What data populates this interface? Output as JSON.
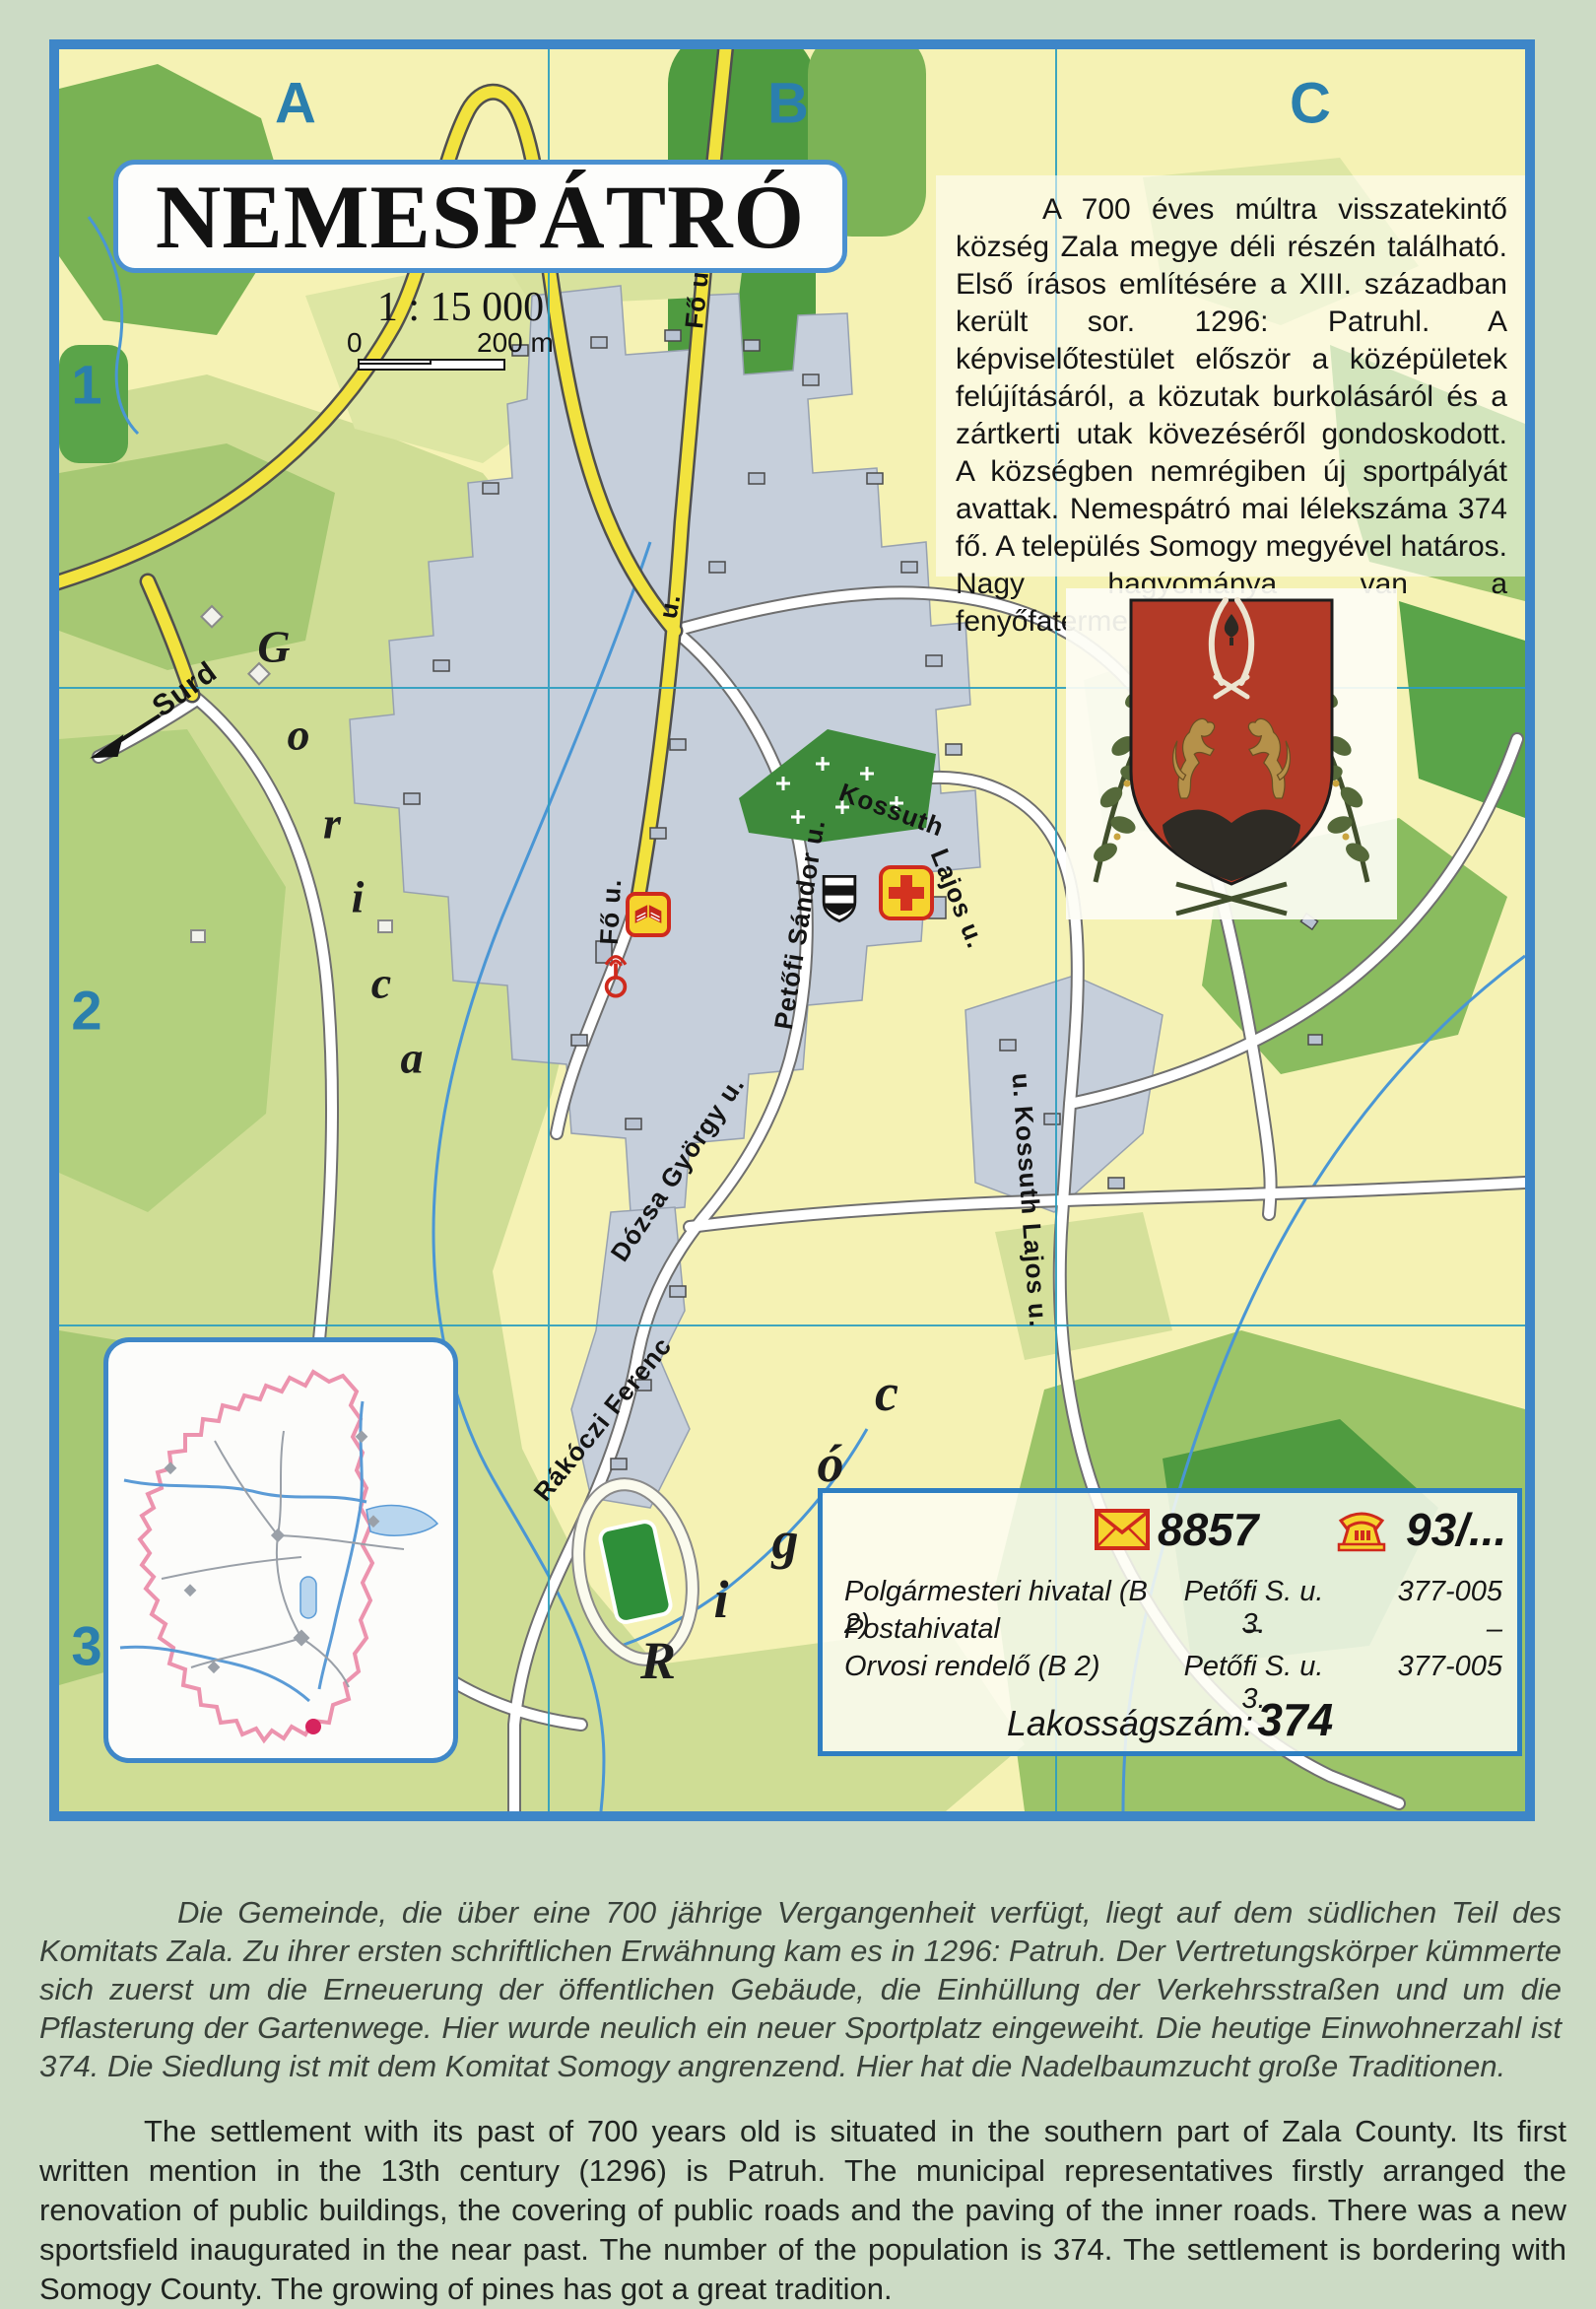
{
  "title": "NEMESPÁTRÓ",
  "scale": {
    "ratio": "1 : 15 000",
    "zero": "0",
    "end": "200 m"
  },
  "grid": {
    "columns": [
      "A",
      "B",
      "C"
    ],
    "rows": [
      "1",
      "2",
      "3"
    ]
  },
  "description_hu": "A 700 éves múltra visszatekintő község Zala megye déli részén található. Első írásos említésére a XIII. században került sor. 1296: Patruhl. A képviselőtestület először a középületek felújításáról, a közutak burkolásáról és a zártkerti utak kövezéséről gondoskodott. A községben nemrégiben új sportpályát avattak. Nemespátró mai lélekszáma 374 fő. A település Somogy megyével határos. Nagy hagyománya van a fenyőfatermesztésnek.",
  "description_de": "Die Gemeinde, die über eine 700 jährige Vergangenheit verfügt, liegt auf dem südlichen Teil des Komitats Zala. Zu ihrer ersten schriftlichen Erwähnung kam es in 1296: Patruh. Der Vertretungskörper kümmerte sich zuerst um die Erneuerung der öffentlichen Gebäude, die Einhüllung der Verkehrsstraßen und um die Pflasterung der Gartenwege. Hier wurde neulich ein neuer Sportplatz eingeweiht. Die heutige Einwohnerzahl ist 374. Die Siedlung ist mit dem Komitat Somogy angrenzend. Hier hat die Nadelbaumzucht große Traditionen.",
  "description_en": "The settlement with its past of 700 years old is situated in the southern part of Zala County. Its first written mention in the 13th century (1296) is Patruh. The municipal representatives firstly arranged the renovation of public buildings, the covering of public roads and the paving of the inner roads. There was a new sportsfield inaugurated in the near past. The number of the population is 374. The settlement is bordering with Somogy County. The growing of pines has got a great tradition.",
  "infobox": {
    "postal_code": "8857",
    "phone_prefix": "93/...",
    "rows": [
      {
        "name": "Polgármesteri hivatal (B 2)",
        "address": "Petőfi S. u. 3.",
        "phone": "377-005"
      },
      {
        "name": "Postahivatal",
        "address": "–",
        "phone": "–"
      },
      {
        "name": "Orvosi rendelő (B 2)",
        "address": "Petőfi S. u. 3.",
        "phone": "377-005"
      }
    ],
    "population_label": "Lakosságszám:",
    "population_value": "374"
  },
  "map": {
    "street_labels": [
      {
        "text": "Fő u."
      },
      {
        "text": "u."
      },
      {
        "text": "Fő u."
      },
      {
        "text": "Petőfi Sándor u."
      },
      {
        "text": "Kossuth"
      },
      {
        "text": "Lajos u."
      },
      {
        "text": "u. Kossuth Lajos u."
      },
      {
        "text": "Dózsa György u."
      },
      {
        "text": "Rákóczi Ferenc"
      },
      {
        "text": "Surd"
      }
    ],
    "gorica_letters": [
      "G",
      "o",
      "r",
      "i",
      "c",
      "a"
    ],
    "rigoc_letters": [
      "R",
      "i",
      "g",
      "ó",
      "c"
    ],
    "icons": {
      "library": "book-icon",
      "monument": "monument-icon",
      "church": "striped-shield-icon",
      "doctor": "medical-cross-icon",
      "post": "envelope-icon",
      "telephone": "rotary-phone-icon"
    }
  },
  "colors": {
    "page_background": "#ccdbc5",
    "map_background": "#f5f2b4",
    "map_border": "#3e86c8",
    "grid_label": "#2b7fad",
    "main_road": "#f2e33e",
    "built_up": "#c6cfdb",
    "forest": "#79b254",
    "cemetery": "#3e8a3b",
    "stream": "#4a96d4",
    "icon_yellow": "#f6d42e",
    "icon_red": "#cf2a1d",
    "shield_red": "#b33a27",
    "boundary_pink": "#ec93ae"
  }
}
